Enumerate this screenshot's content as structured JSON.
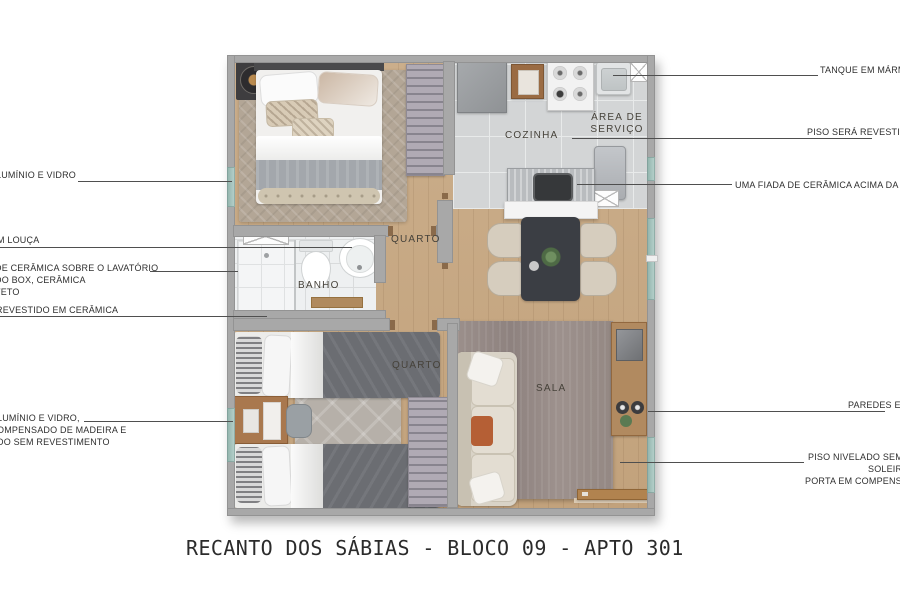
{
  "title": "RECANTO DOS SÁBIAS - BLOCO 09 - APTO 301",
  "rooms": {
    "cozinha": "COZINHA",
    "area_servico": {
      "line1": "ÁREA DE",
      "line2": "SERVIÇO"
    },
    "quarto_top": "QUARTO",
    "banho": "BANHO",
    "quarto_bottom": "QUARTO",
    "sala": "SALA"
  },
  "callouts_left": [
    {
      "lines": [
        "LUMÍNIO E VIDRO"
      ]
    },
    {
      "lines": [
        "M LOUÇA"
      ]
    },
    {
      "lines": [
        "DE CERÂMICA SOBRE O LAVATÓRIO",
        "DO BOX, CERÂMICA",
        "TETO"
      ]
    },
    {
      "lines": [
        "REVESTIDO EM CERÂMICA"
      ]
    },
    {
      "lines": [
        "LUMÍNIO E VIDRO,",
        "OMPENSADO DE MADEIRA E",
        "DO SEM REVESTIMENTO"
      ]
    }
  ],
  "callouts_right": [
    {
      "lines": [
        "TANQUE EM MÁRMO"
      ]
    },
    {
      "lines": [
        "PISO SERÁ REVESTIDO"
      ]
    },
    {
      "lines": [
        "UMA FIADA DE CERÂMICA ACIMA DA PI"
      ]
    },
    {
      "lines": [
        "PAREDES EM"
      ]
    },
    {
      "lines": [
        "PISO NIVELADO SEM",
        "SOLEIR",
        "PORTA EM COMPENSAD"
      ]
    }
  ],
  "colors": {
    "wall": "#a8a8a8",
    "wood_floor": "#c7a986",
    "kitchen_tile": "#d3d5d6",
    "bath_tile": "#eef0f1",
    "window_glass": "#9dbcb6",
    "sala_rug": "#948883",
    "bedroom_rug": "#b3a696",
    "sofa": "#d9d3c7",
    "dining_table": "#3b3e44",
    "door_wood": "#b1834f",
    "leader_line": "#4f4f4f",
    "title_text": "#2b2b2b"
  }
}
